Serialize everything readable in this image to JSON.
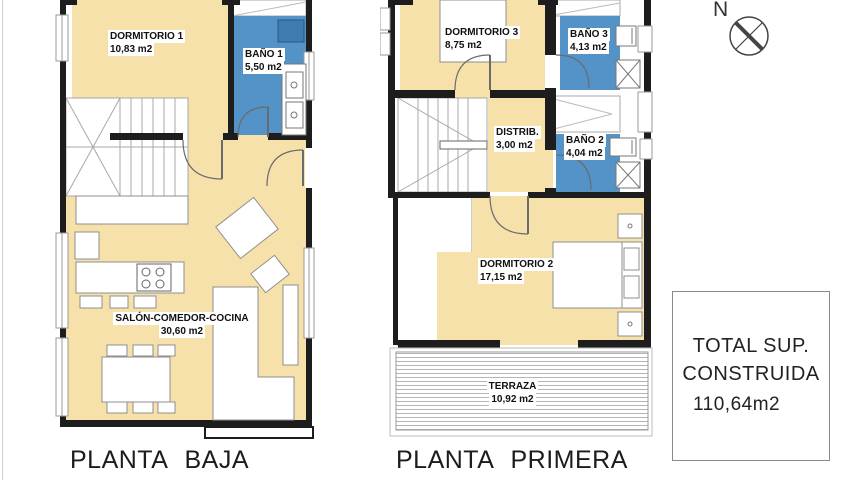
{
  "plans": [
    {
      "title": "PLANTA BAJA",
      "rooms": [
        {
          "name": "DORMITORIO 1",
          "area": "10,83 m2"
        },
        {
          "name": "BAÑO 1",
          "area": "5,50 m2"
        },
        {
          "name": "SALÓN-COMEDOR-COCINA",
          "area": "30,60 m2"
        }
      ]
    },
    {
      "title": "PLANTA PRIMERA",
      "rooms": [
        {
          "name": "DORMITORIO 3",
          "area": "8,75 m2"
        },
        {
          "name": "BAÑO 3",
          "area": "4,13 m2"
        },
        {
          "name": "DISTRIB.",
          "area": "3,00 m2"
        },
        {
          "name": "BAÑO 2",
          "area": "4,04 m2"
        },
        {
          "name": "DORMITORIO 2",
          "area": "17,15 m2"
        },
        {
          "name": "TERRAZA",
          "area": "10,92 m2"
        }
      ]
    }
  ],
  "summary": {
    "title_line1": "TOTAL SUP.",
    "title_line2": "CONSTRUIDA",
    "value": "110,64m2"
  },
  "compass": {
    "label": "N"
  },
  "colors": {
    "floor_beige": "#F6E1AB",
    "bath_blue": "#5493C8",
    "fixture_blue": "#3F7CB1",
    "wall_black": "#1d1d1d"
  }
}
